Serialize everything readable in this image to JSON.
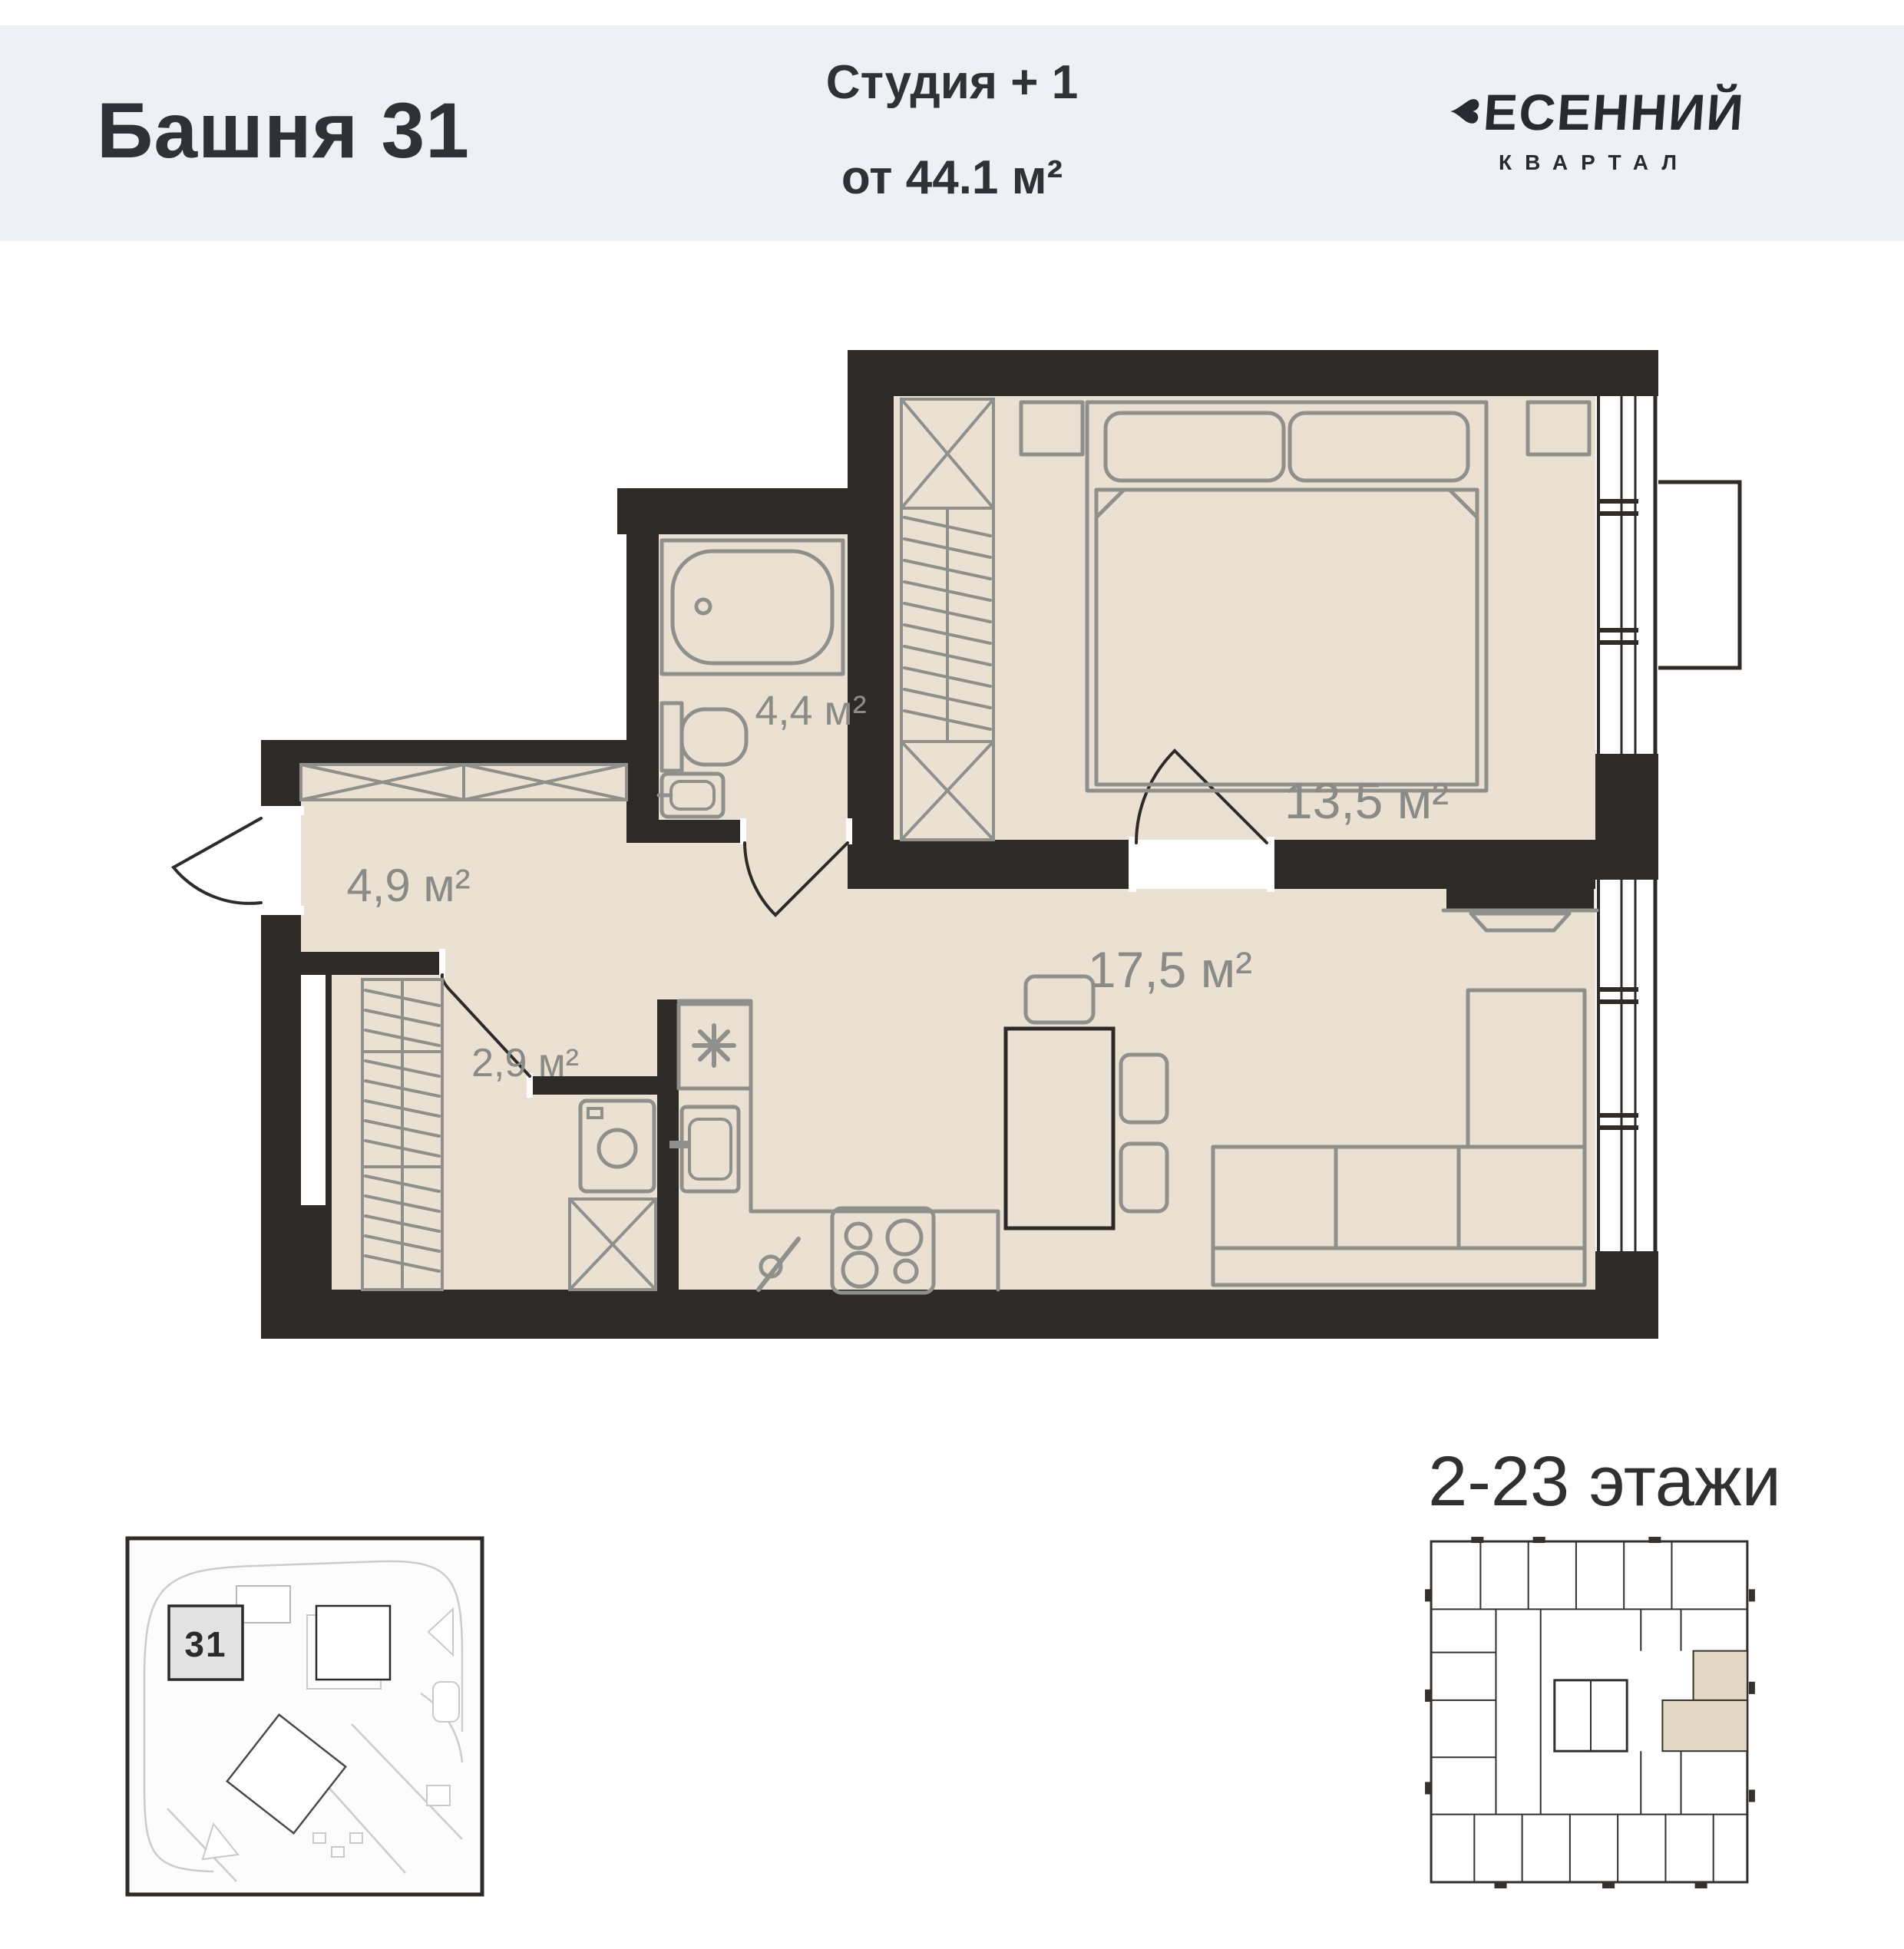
{
  "header": {
    "tower_title": "Башня 31",
    "unit_type": "Студия + 1",
    "unit_area": "от 44.1 м²"
  },
  "brand": {
    "icon": "heart-icon",
    "name_rest": "ЕСЕННИЙ",
    "subtitle": "КВАРТАЛ"
  },
  "plan": {
    "rooms": [
      {
        "id": "bathroom",
        "area_label": "4,4 м²"
      },
      {
        "id": "bedroom",
        "area_label": "13,5 м²"
      },
      {
        "id": "hallway",
        "area_label": "4,9 м²"
      },
      {
        "id": "living_kitchen",
        "area_label": "17,5 м²"
      },
      {
        "id": "closet",
        "area_label": "2,9 м²"
      }
    ]
  },
  "floors_note": "2-23 этажи",
  "site_plan": {
    "building_marker": "31"
  },
  "colors": {
    "header_background": "#edf0f4",
    "walls": "#2d2a27",
    "floor_fill": "#eae1d2",
    "furniture_stroke": "#8f8f8c",
    "area_label": "#8a8a87",
    "highlight_apartment": "#e2d7c3",
    "text": "#2f3136"
  }
}
